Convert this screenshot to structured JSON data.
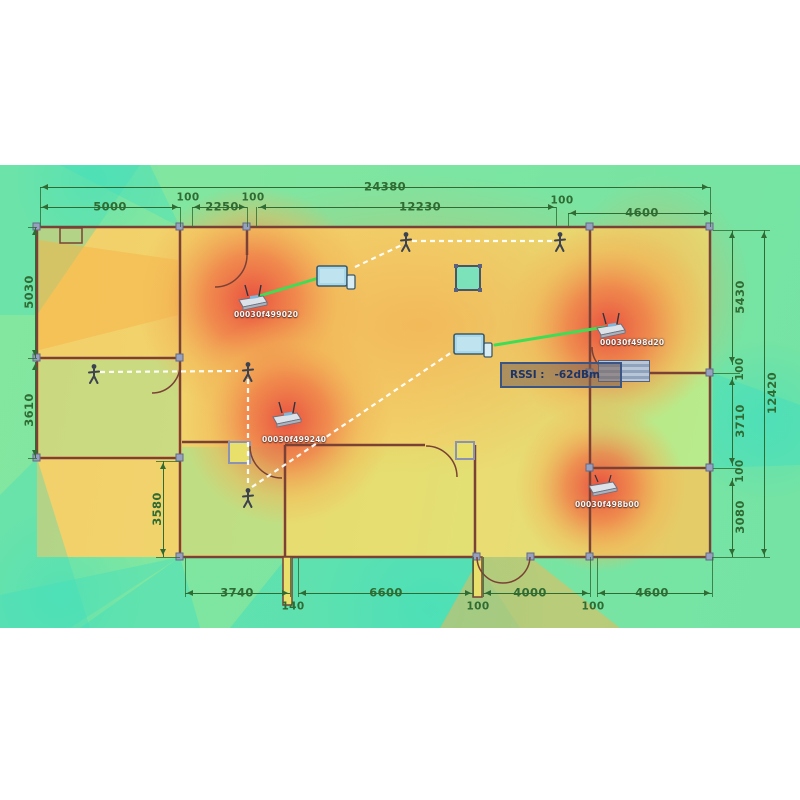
{
  "title": "Wi-Fi coverage heatmap over building floor plan",
  "tooltip": {
    "label": "RSSI :",
    "value": "-62dBm"
  },
  "aps": [
    {
      "id": "00030f499020"
    },
    {
      "id": "00030f498d20"
    },
    {
      "id": "00030f499240"
    },
    {
      "id": "00030f498b00"
    }
  ],
  "dims": {
    "d24380": "24380",
    "d5000": "5000",
    "d100a": "100",
    "d2250": "2250",
    "d100b": "100",
    "d12230": "12230",
    "d100c": "100",
    "d4600t": "4600",
    "d5030": "5030",
    "d3610": "3610",
    "d3580": "3580",
    "d5430": "5430",
    "d100r1": "100",
    "d3710": "3710",
    "d100r2": "100",
    "d3080": "3080",
    "d12420": "12420",
    "d3740": "3740",
    "d140": "140",
    "d6600": "6600",
    "d100d": "100",
    "d4000": "4000",
    "d100e": "100",
    "d4600b": "4600"
  },
  "colors": {
    "hotspot": "#e84a3e",
    "warm": "#f5a04a",
    "mid_yellow": "#efe06a",
    "outside_green": "#7ee69e",
    "cold_teal": "#40dedf",
    "wall": "#7a4136",
    "dimension_text": "#2f6b33",
    "link_line": "#3edd55",
    "walk_path": "#ffffff",
    "tooltip_border": "#3a5584"
  }
}
